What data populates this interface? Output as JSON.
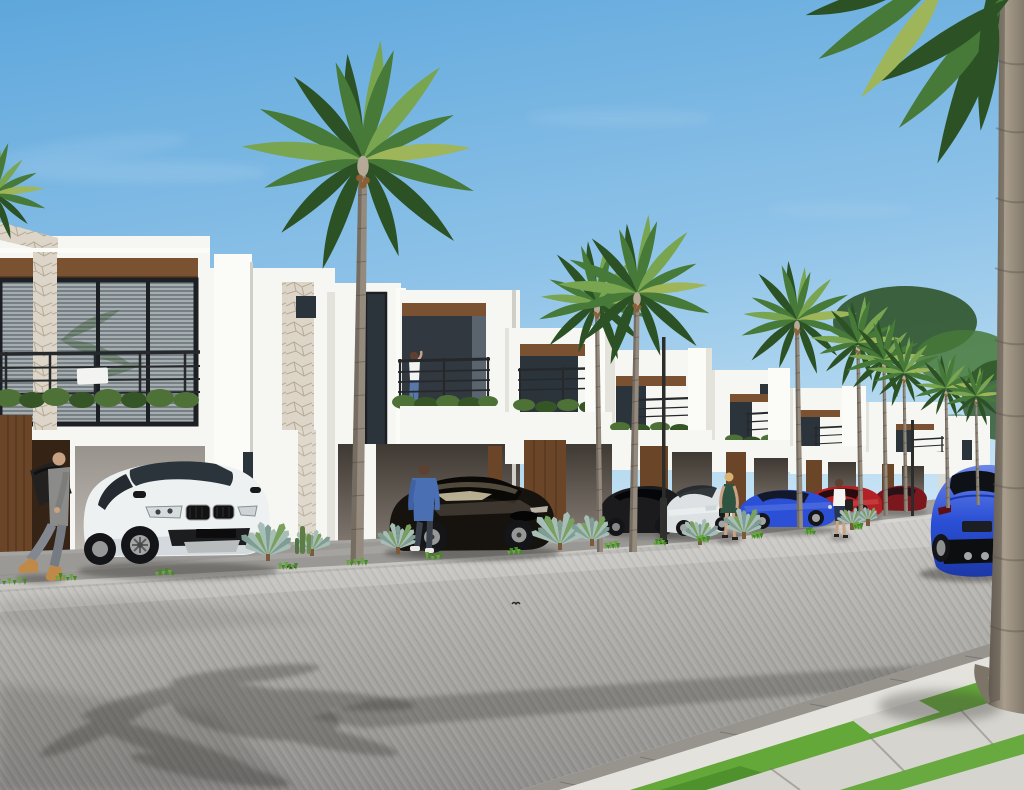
{
  "scene": {
    "description": "Photorealistic architectural render of a row of modern white two-storey townhouses along a paved street lined with royal palms; luxury cars parked in carports; pedestrians on the kerb; large out-of-focus palm trunk at right foreground.",
    "houses": [
      {
        "id": "house-1",
        "label": "white townhouse with full-width glass window, stone parapet, balcony rail and carport"
      },
      {
        "id": "house-annex",
        "label": "white stair-tower annex with stone panel and small square window"
      },
      {
        "id": "house-2",
        "label": "white townhouse with recessed balcony, woman standing on balcony, carport below"
      },
      {
        "id": "house-3",
        "label": "white townhouse with recessed balcony and timber entry door"
      },
      {
        "id": "house-4",
        "label": "white townhouse, receding"
      },
      {
        "id": "house-5",
        "label": "white townhouse, receding"
      },
      {
        "id": "house-6",
        "label": "white townhouse, receding"
      },
      {
        "id": "house-7",
        "label": "white townhouse, receding"
      },
      {
        "id": "house-8",
        "label": "farthest white townhouse sliver"
      }
    ],
    "vehicles": [
      {
        "id": "car-bmw-x6",
        "label": "white BMW X6",
        "color": "#eef1f2"
      },
      {
        "id": "car-tesla",
        "label": "black Tesla Model S",
        "color": "#16130e"
      },
      {
        "id": "car-dark-sedan",
        "label": "dark sedan behind fan palm",
        "color": "#1b1b1d"
      },
      {
        "id": "car-audi",
        "label": "white Audi A7",
        "color": "#dde1e3"
      },
      {
        "id": "car-porsche-small",
        "label": "blue Porsche 911 coupe",
        "color": "#2b50d6"
      },
      {
        "id": "car-red-sedan",
        "label": "red sedan",
        "color": "#b22126"
      },
      {
        "id": "car-maroon",
        "label": "dark red car",
        "color": "#7a181d"
      },
      {
        "id": "car-silver",
        "label": "silver car in distance",
        "color": "#dde1e3"
      },
      {
        "id": "car-porsche-rear",
        "label": "blue Porsche 911 seen from rear",
        "color": "#2b50d6"
      }
    ],
    "people": [
      {
        "id": "man-duffel",
        "label": "bald man walking left with black duffel bag, grey outfit, tan boots"
      },
      {
        "id": "man-denim",
        "label": "man in blue denim shirt walking toward black Tesla"
      },
      {
        "id": "woman-balcony",
        "label": "woman in white top standing on balcony"
      },
      {
        "id": "woman-green-dress",
        "label": "blonde woman in dark green dress on kerb"
      },
      {
        "id": "woman-white-top",
        "label": "woman in white top and navy skirt with bag"
      }
    ],
    "street": {
      "lamp_posts": 2,
      "birds": 2,
      "surface": "grey paver road with palm shadows",
      "sidewalk": "light concrete slabs with grass strips, bottom right"
    },
    "palms": [
      {
        "bx": 357,
        "by": 563,
        "tx": 363,
        "ty": 162,
        "w": 13,
        "s": 1.15,
        "label": "tall foxtail palm, centre left"
      },
      {
        "bx": 600,
        "by": 552,
        "tx": 597,
        "ty": 305,
        "w": 6,
        "s": 0.6
      },
      {
        "bx": 633,
        "by": 552,
        "tx": 637,
        "ty": 295,
        "w": 8,
        "s": 0.76
      },
      {
        "bx": 800,
        "by": 528,
        "tx": 797,
        "ty": 322,
        "w": 6,
        "s": 0.58
      },
      {
        "bx": 861,
        "by": 520,
        "tx": 858,
        "ty": 345,
        "w": 5,
        "s": 0.46
      },
      {
        "bx": 886,
        "by": 516,
        "tx": 884,
        "ty": 362,
        "w": 4.5,
        "s": 0.4
      },
      {
        "bx": 906,
        "by": 512,
        "tx": 904,
        "ty": 375,
        "w": 4,
        "s": 0.36
      },
      {
        "bx": 948,
        "by": 508,
        "tx": 946,
        "ty": 390,
        "w": 4,
        "s": 0.33
      },
      {
        "bx": 978,
        "by": 505,
        "tx": 976,
        "ty": 398,
        "w": 3.5,
        "s": 0.29
      },
      {
        "bx": -8,
        "by": 232,
        "tx": -6,
        "ty": 196,
        "w": 4,
        "s": 0.5,
        "label": "palm crown peeking at left edge"
      }
    ],
    "fan_palms": [
      {
        "x": 268,
        "y": 556,
        "s": 34
      },
      {
        "x": 312,
        "y": 551,
        "s": 22
      },
      {
        "x": 398,
        "y": 549,
        "s": 26
      },
      {
        "x": 560,
        "y": 545,
        "s": 34
      },
      {
        "x": 592,
        "y": 541,
        "s": 26
      },
      {
        "x": 700,
        "y": 540,
        "s": 22
      },
      {
        "x": 744,
        "y": 534,
        "s": 26
      },
      {
        "x": 852,
        "y": 525,
        "s": 18
      },
      {
        "x": 868,
        "y": 521,
        "s": 14
      }
    ],
    "grass_tufts": [
      {
        "x": 12,
        "y": 584,
        "w": 26
      },
      {
        "x": 66,
        "y": 580,
        "w": 18
      },
      {
        "x": 165,
        "y": 575,
        "w": 16
      },
      {
        "x": 288,
        "y": 569,
        "w": 16
      },
      {
        "x": 357,
        "y": 565,
        "w": 18
      },
      {
        "x": 434,
        "y": 559,
        "w": 14
      },
      {
        "x": 515,
        "y": 554,
        "w": 12
      },
      {
        "x": 612,
        "y": 548,
        "w": 12
      },
      {
        "x": 660,
        "y": 545,
        "w": 10
      },
      {
        "x": 703,
        "y": 542,
        "w": 10
      },
      {
        "x": 757,
        "y": 538,
        "w": 9
      },
      {
        "x": 810,
        "y": 534,
        "w": 8
      },
      {
        "x": 858,
        "y": 529,
        "w": 7
      }
    ]
  },
  "palette": {
    "sky-top": "#5ea7dc",
    "sky-mid": "#8fc3e8",
    "sky-low": "#c8e4f4",
    "cloud": "#ffffff",
    "wall-lit": "#f6f6f2",
    "wall-bright": "#fbfbf8",
    "wall-shade": "#e3e2db",
    "wall-dark": "#cfcec7",
    "soffit": "#7a5231",
    "soffit-dark": "#5d3c20",
    "glass": "#2c343b",
    "glass-light": "#48565f",
    "window-blind": "#767f83",
    "blind-line": "#ccd1d3",
    "frame": "#1c2024",
    "rail": "#26292c",
    "hedge": "#4d7137",
    "hedge-dark": "#365527",
    "stone": "#dcd5c8",
    "stone-line": "#ac9f8a",
    "door-brown": "#6a4527",
    "door-dark": "#352415",
    "carport-top": "#4a423a",
    "carport-bot": "#998f84",
    "trunk": "#948b7e",
    "trunk-dark": "#675f54",
    "trunk-light": "#b5aa97",
    "palm-dark": "#2c5125",
    "palm-mid": "#477938",
    "palm-light": "#79a450",
    "palm-yellow": "#9fb559",
    "fan-palm": "#a6beb5",
    "fan-dark": "#7f9d93",
    "fan-green": "#79a05c",
    "apron": "#a5a3a0",
    "kerb": "#d7d6d1",
    "road-far": "#c6c4bf",
    "road-near": "#8f8e8c",
    "gutter": "#97948e",
    "pave": "#d5d4ce",
    "pave-joint": "#b2b1ab",
    "grass": "#63a838",
    "grass-dark": "#47872a",
    "shadow": "#3c3b38",
    "car-white": "#eef1f2",
    "car-white-shade": "#c3cad0",
    "car-black": "#16130e",
    "car-black-hi": "#8d8069",
    "car-silver": "#dde1e3",
    "car-dark2": "#1b1b1d",
    "porsche-blue": "#2b50d6",
    "porsche-hi": "#6d87e8",
    "car-red": "#b22126",
    "car-maroon": "#7a181d",
    "tire": "#141518",
    "rim": "#a4a6a6",
    "skin": "#c9a183",
    "denim": "#4a6fb3",
    "jeans": "#787d85",
    "jeans-dark": "#3a414b",
    "boot": "#bf8a49",
    "grey-top": "#8b8b89",
    "bag-black": "#232120",
    "dress-green": "#2e5340",
    "skirt-navy": "#2b3550",
    "hair-brown": "#5d4030",
    "hair-blonde": "#d6b273",
    "cloth-white": "#f3f4f2"
  }
}
